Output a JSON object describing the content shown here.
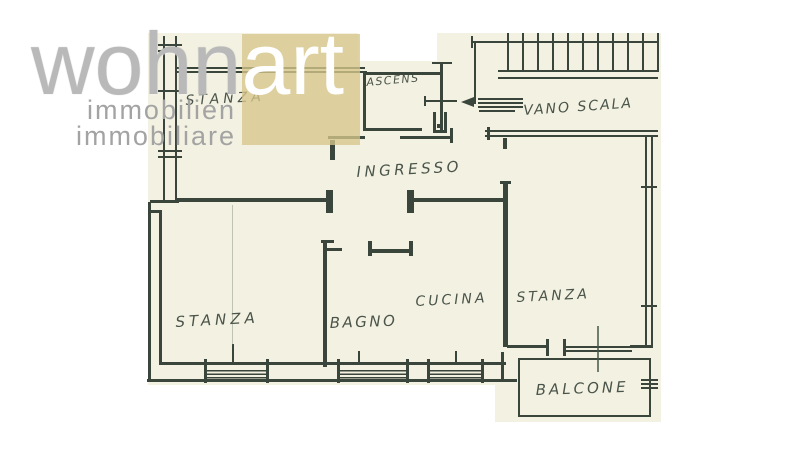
{
  "logo": {
    "wordmark_gray": "wohn",
    "wordmark_accent": "art",
    "subtitle_de": "immobilien",
    "subtitle_it": "immobiliare"
  },
  "floorplan": {
    "labels": {
      "stanza_tl": "STANZA",
      "ascens": "ASCENS",
      "vano_scala": "VANO SCALA",
      "ingresso": "INGRESSO",
      "stanza_left": "STANZA",
      "bagno": "BAGNO",
      "cucina": "CUCINA",
      "stanza_right": "STANZA",
      "balcone": "BALCONE"
    }
  },
  "colors": {
    "paper": "#f3f1e1",
    "ink": "#3a453c",
    "ink_soft": "#414c42",
    "watermark_square": "rgba(214,199,138,0.78)",
    "logo_gray": "#b9b9b9",
    "logo_white": "#ffffff",
    "subtitle_gray": "#a3a3a3"
  }
}
